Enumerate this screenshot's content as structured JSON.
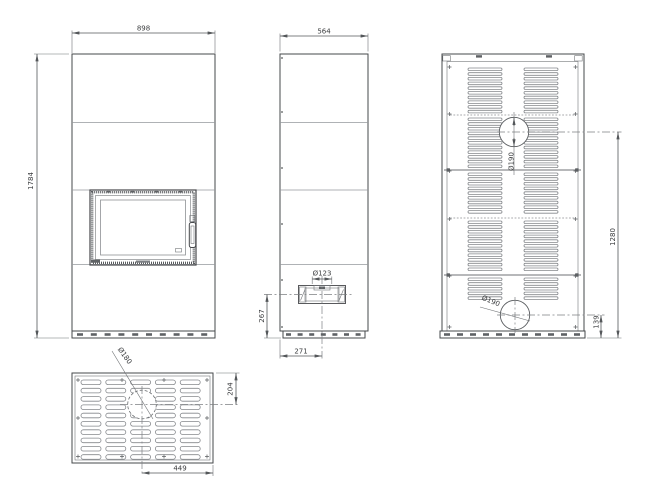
{
  "views": {
    "front": {
      "width": "898",
      "height": "1784"
    },
    "side": {
      "depth": "564",
      "outlet_diameter": "Ø123",
      "outlet_center_height": "267",
      "outlet_center_offset": "271"
    },
    "back": {
      "upper_flue_diameter": "Ø190",
      "upper_flue_center_height": "1280",
      "lower_flue_diameter": "Ø190",
      "lower_flue_center_height": "139"
    },
    "top": {
      "flue_diameter": "Ø180",
      "flue_center_from_back": "204",
      "flue_center_from_side": "449"
    }
  },
  "colors": {
    "background": "#ffffff",
    "line": "#46484b",
    "dimension": "#54575a"
  }
}
